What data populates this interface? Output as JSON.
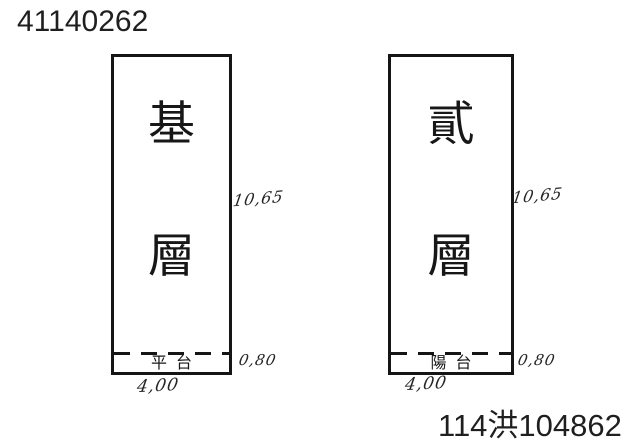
{
  "header": {
    "doc_number": "41140262"
  },
  "footer": {
    "case_number": "114洪104862"
  },
  "diagrams": [
    {
      "name": "base-floor",
      "floor_char_top": "基",
      "floor_char_bottom": "層",
      "compartment_label": "平台",
      "height_dim": "10,65",
      "compartment_dim": "0,80",
      "width_dim": "4,00"
    },
    {
      "name": "second-floor",
      "floor_char_top": "貳",
      "floor_char_bottom": "層",
      "compartment_label": "陽台",
      "height_dim": "10,65",
      "compartment_dim": "0,80",
      "width_dim": "4,00"
    }
  ],
  "colors": {
    "ink": "#1b1b1b",
    "background": "#ffffff"
  }
}
